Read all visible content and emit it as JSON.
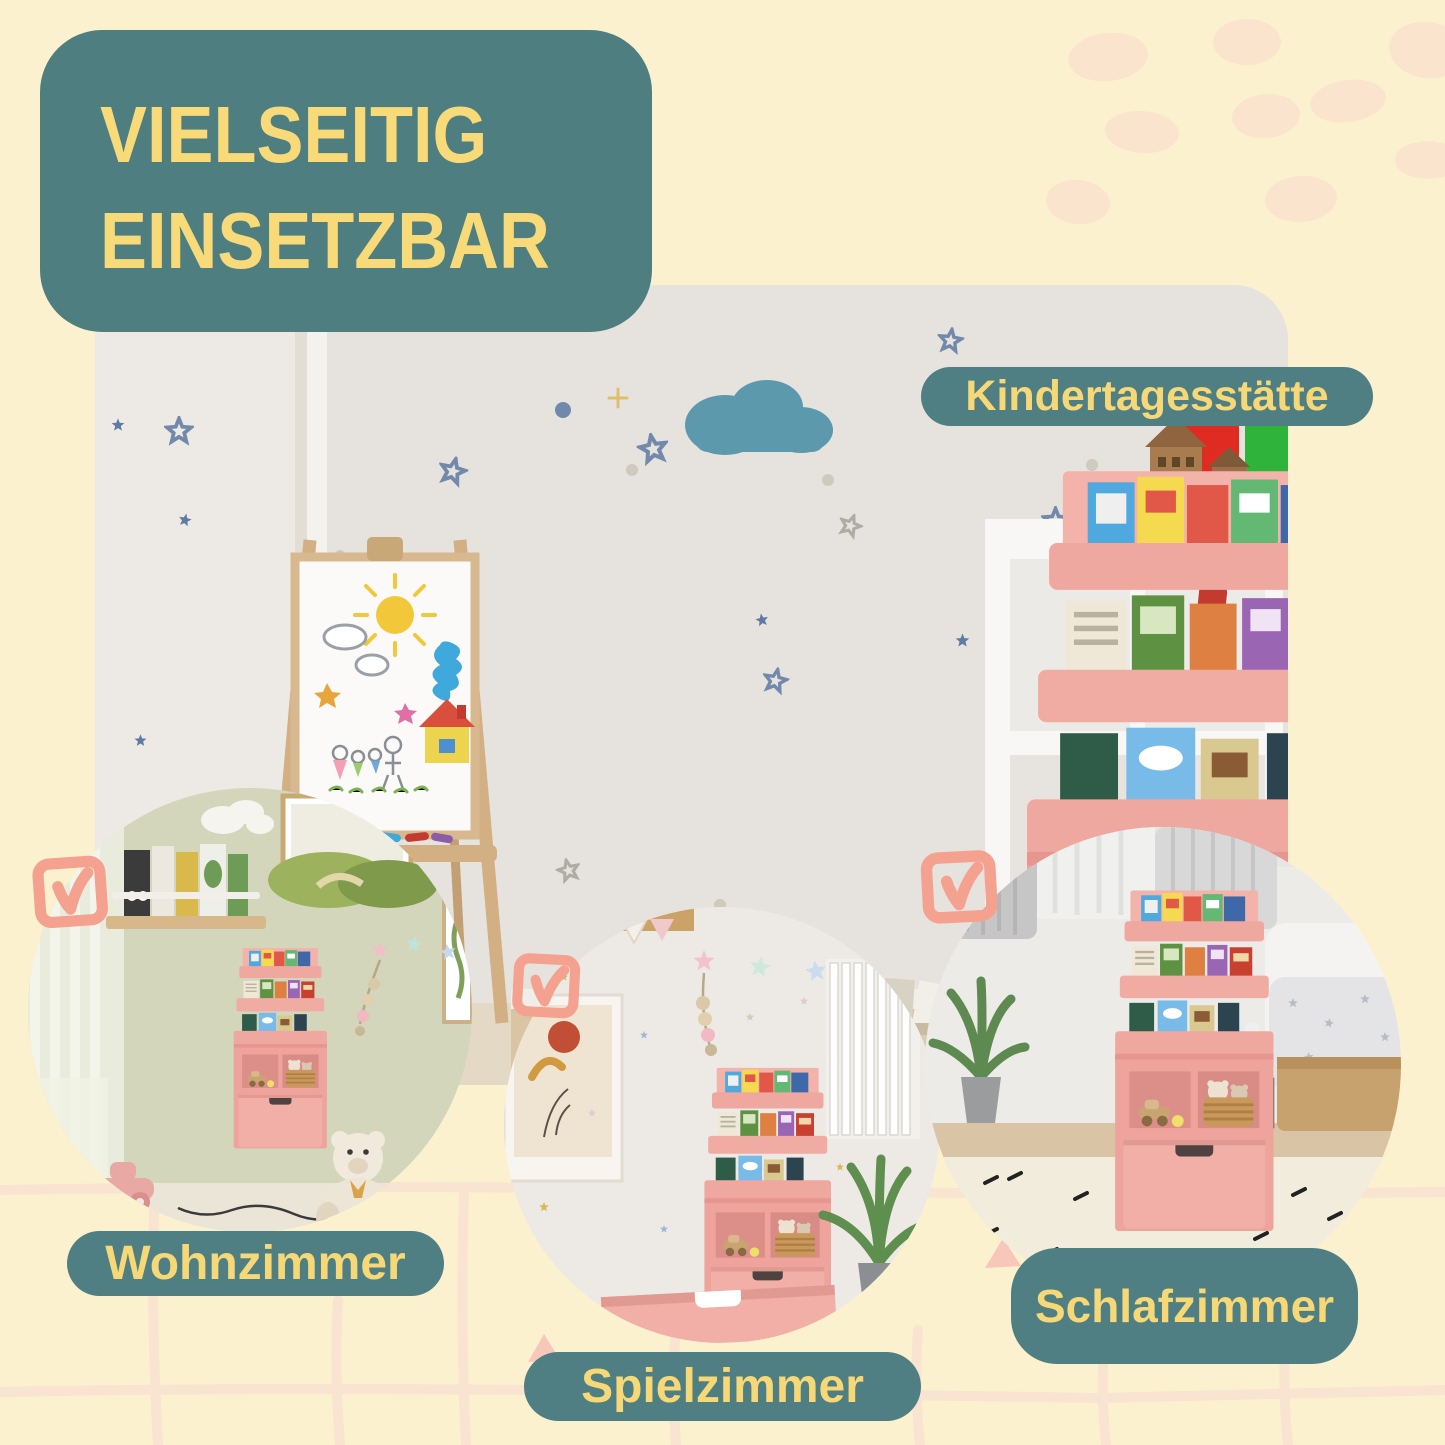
{
  "page": {
    "type": "product-infographic",
    "language": "de",
    "background": "#FBF1CF"
  },
  "banner": {
    "line1": "VIELSEITIG",
    "line2": "EINSETZBAR",
    "bg": "#4E7E80",
    "text_color": "#F8DA78"
  },
  "labels": {
    "kindergarten": "Kindertagesstätte",
    "living_room": "Wohnzimmer",
    "playroom": "Spielzimmer",
    "bedroom": "Schlafzimmer"
  },
  "icons": {
    "checkbox": "checkbox-check-icon",
    "checkbox_count": 3,
    "checkbox_color": "#F4A28F"
  },
  "colors": {
    "teal": "#4E7E80",
    "yellow": "#F8DA78",
    "cream": "#FBF1CF",
    "peach_blob": "#FAE4CD",
    "grid_line": "#F9E3D1",
    "product_pink": "#EEA49C",
    "check_salmon": "#F4A28F"
  }
}
